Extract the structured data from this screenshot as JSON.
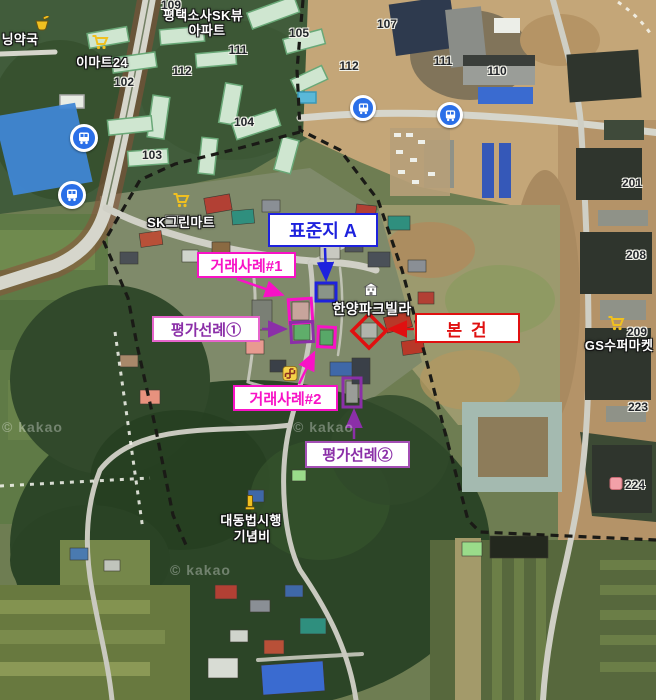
{
  "map": {
    "watermark": "© kakao",
    "provider_note": "satellite basemap"
  },
  "colors": {
    "annotation_blue": "#1e22dd",
    "annotation_magenta": "#f812c6",
    "annotation_purple": "#8b2fa8",
    "annotation_pink_border": "#e665cc",
    "annotation_red": "#e51111",
    "poi_icon_yellow": "#f0c020",
    "bus_icon_blue": "#2a6fe8"
  },
  "callouts": {
    "standard_lot": {
      "label": "표준지 A"
    },
    "sale_case1": {
      "label": "거래사례#1"
    },
    "precedent1": {
      "label": "평가선례①"
    },
    "subject": {
      "label": "본 건"
    },
    "sale_case2": {
      "label": "거래사례#2"
    },
    "precedent2": {
      "label": "평가선례②"
    }
  },
  "pois": {
    "pharmacy": "닝약국",
    "emart": "이마트24",
    "sk_view_line1": "평택소사SK뷰",
    "sk_view_line2": "아파트",
    "sk_green_mart": "SK그린마트",
    "hanyang_villa": "한양파크빌라",
    "gs_supermarket": "GS수퍼마켓",
    "monument_line1": "대동법시행",
    "monument_line2": "기념비"
  },
  "building_numbers": [
    "109",
    "105",
    "107",
    "111",
    "112",
    "102",
    "103",
    "104",
    "112",
    "111",
    "110",
    "201",
    "208",
    "209",
    "223",
    "224"
  ]
}
